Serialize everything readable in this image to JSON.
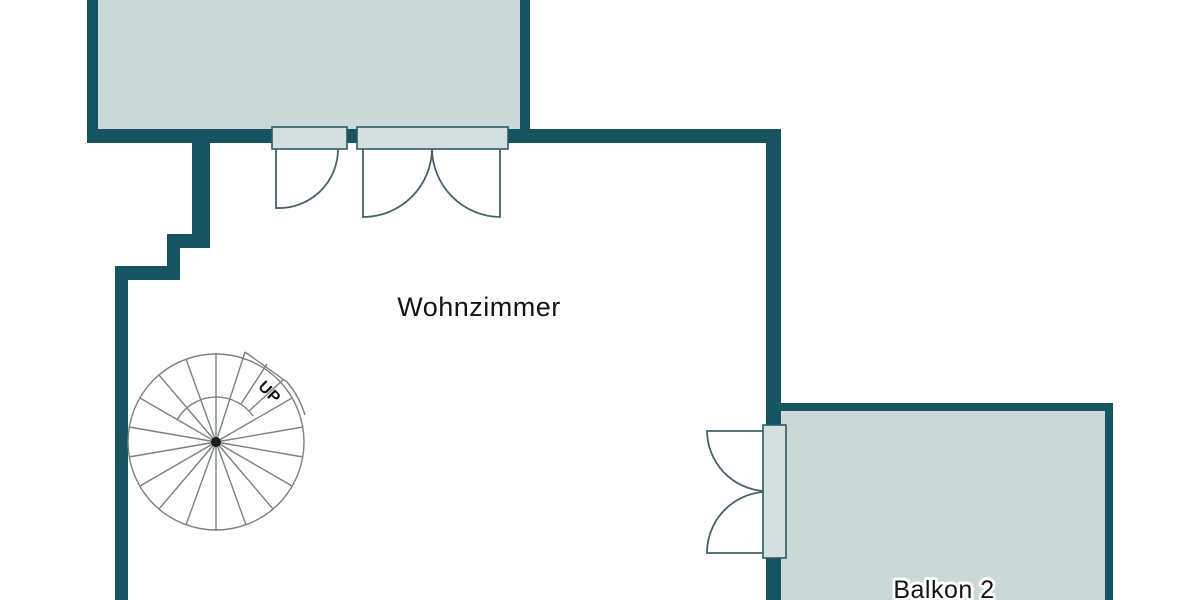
{
  "plan": {
    "rooms": {
      "living_room": {
        "label": "Wohnzimmer"
      },
      "balcony_2": {
        "label": "Balkon 2"
      }
    },
    "stairs": {
      "direction_label": "UP"
    }
  },
  "colors": {
    "background": "#ffffff",
    "wall": "#175361",
    "area_fill": "#cbd8d8",
    "door_frame_fill": "#d4dfde",
    "door_frame_stroke": "#2d5a64",
    "door_stroke": "#44626b",
    "stair_stroke": "#79827f",
    "stair_center": "#1d1d1d",
    "label_color": "#141414"
  }
}
